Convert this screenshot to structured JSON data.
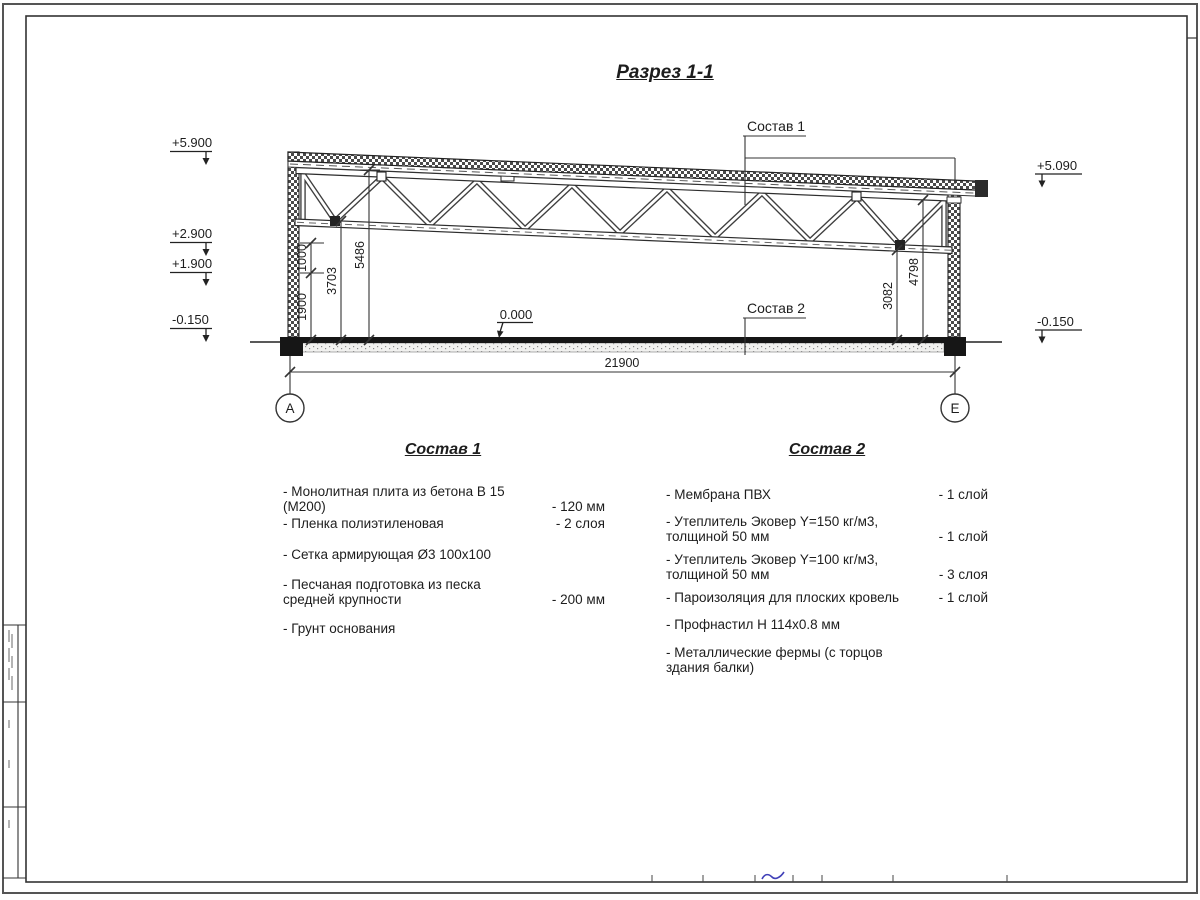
{
  "title": "Разрез 1-1",
  "drawing": {
    "elevations": {
      "left_top": "+5.900",
      "left_mid1": "+2.900",
      "left_mid2": "+1.900",
      "left_bottom": "-0.150",
      "right_top": "+5.090",
      "right_bottom": "-0.150",
      "floor": "0.000"
    },
    "dims": {
      "d1900": "1900",
      "d1000": "1000",
      "d3703": "3703",
      "d5486": "5486",
      "d3082": "3082",
      "d4798": "4798",
      "overall": "21900"
    },
    "axes": {
      "left": "А",
      "right": "Е"
    },
    "callouts": {
      "roof": "Состав 1",
      "floor": "Состав 2"
    }
  },
  "composition1": {
    "heading": "Состав 1",
    "items": [
      {
        "text": "- Монолитная плита из бетона В 15 (М200)",
        "value": "- 120 мм"
      },
      {
        "text": "- Пленка полиэтиленовая",
        "value": "- 2 слоя"
      },
      {
        "text": "- Сетка армирующая Ø3 100х100",
        "value": ""
      },
      {
        "text": "- Песчаная подготовка из песка\nсредней крупности",
        "value": "- 200 мм"
      },
      {
        "text": "- Грунт основания",
        "value": ""
      }
    ]
  },
  "composition2": {
    "heading": "Состав 2",
    "items": [
      {
        "text": "- Мембрана ПВХ",
        "value": "- 1 слой"
      },
      {
        "text": "- Утеплитель Эковер Y=150 кг/м3,\nтолщиной 50 мм",
        "value": "- 1 слой"
      },
      {
        "text": "- Утеплитель Эковер Y=100 кг/м3,\nтолщиной 50 мм",
        "value": "- 3 слоя"
      },
      {
        "text": "- Пароизоляция для плоских кровель",
        "value": "- 1 слой"
      },
      {
        "text": "- Профнастил Н 114х0.8 мм",
        "value": ""
      },
      {
        "text": "- Металлические фермы (с торцов здания балки)",
        "value": ""
      }
    ]
  }
}
